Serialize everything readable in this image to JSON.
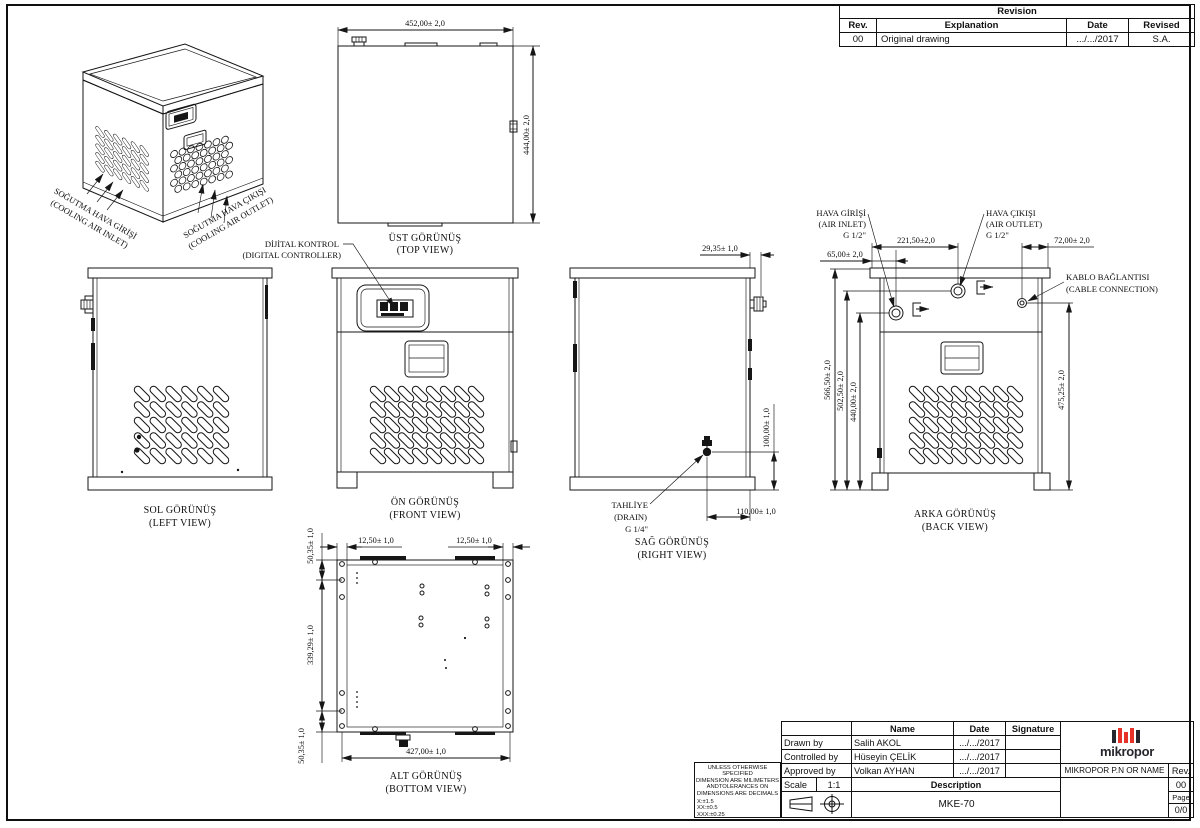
{
  "colors": {
    "line": "#161616",
    "logo_red": "#e63329",
    "logo_dark": "#26262e"
  },
  "iso_view": {
    "inlet_line1": "SOĞUTMA HAVA GİRİŞİ",
    "inlet_line2": "(COOLING AIR INLET)",
    "outlet_line1": "SOĞUTMA HAVA ÇIKIŞI",
    "outlet_line2": "(COOLING AIR OUTLET)"
  },
  "top_view": {
    "title": "ÜST GÖRÜNÜŞ",
    "subtitle": "(TOP VIEW)",
    "dim_width": "452,00± 2,0",
    "dim_depth": "444,00± 2,0"
  },
  "left_view": {
    "title": "SOL GÖRÜNÜŞ",
    "subtitle": "(LEFT VIEW)"
  },
  "front_view": {
    "title": "ÖN GÖRÜNÜŞ",
    "subtitle": "(FRONT VIEW)",
    "controller_line1": "DİJİTAL KONTROL",
    "controller_line2": "(DIGITAL CONTROLLER)"
  },
  "right_view": {
    "title": "SAĞ GÖRÜNÜŞ",
    "subtitle": "(RIGHT VIEW)",
    "dim_gland": "29,35± 1,0",
    "dim_drain_h": "100,00± 1,0",
    "dim_drain_x": "110,00± 1,0",
    "drain_line1": "TAHLİYE",
    "drain_line2": "(DRAIN)",
    "drain_line3": "G 1/4\""
  },
  "back_view": {
    "title": "ARKA GÖRÜNÜŞ",
    "subtitle": "(BACK VIEW)",
    "inlet_line1": "HAVA GİRİŞİ",
    "inlet_line2": "(AIR INLET)",
    "inlet_line3": "G 1/2\"",
    "outlet_line1": "HAVA ÇIKIŞI",
    "outlet_line2": "(AIR OUTLET)",
    "outlet_line3": "G 1/2\"",
    "cable_line1": "KABLO BAĞLANTISI",
    "cable_line2": "(CABLE CONNECTION)",
    "dim_inlet_x": "65,00± 2,0",
    "dim_outlet_x": "221,50±2,0",
    "dim_cable_x": "72,00± 2,0",
    "dim_total_h": "566,50± 2,0",
    "dim_outlet_h": "502,50± 2,0",
    "dim_inlet_h": "440,00± 2,0",
    "dim_cable_h": "475,25± 2,0"
  },
  "bottom_view": {
    "title": "ALT GÖRÜNÜŞ",
    "subtitle": "(BOTTOM VIEW)",
    "dim_rail_left": "12,50± 1,0",
    "dim_rail_right": "12,50± 1,0",
    "dim_top_offset": "50,35± 1,0",
    "dim_slot_span": "339,29± 1,0",
    "dim_bottom_offset": "50,35± 1,0",
    "dim_width": "427,00± 1,0"
  },
  "revision_table": {
    "title": "Revision",
    "col_rev": "Rev.",
    "col_explanation": "Explanation",
    "col_date": "Date",
    "col_revised": "Revised",
    "row_rev": "00",
    "row_explanation": "Original drawing",
    "row_date": ".../.../2017",
    "row_revised": "S.A."
  },
  "title_block": {
    "col_name": "Name",
    "col_date": "Date",
    "col_signature": "Signature",
    "drawn_label": "Drawn by",
    "drawn_name": "Salih AKOL",
    "drawn_date": ".../.../2017",
    "controlled_label": "Controlled by",
    "controlled_name": "Hüseyin ÇELİK",
    "controlled_date": ".../.../2017",
    "approved_label": "Approved by",
    "approved_name": "Volkan AYHAN",
    "approved_date": ".../.../2017",
    "scale_label": "Scale",
    "scale_value": "1:1",
    "description_label": "Description",
    "description_value": "MKE-70",
    "pn_label": "MIKROPOR P.N OR NAME",
    "rev_label": "Rev.",
    "rev_value": "00",
    "page_label": "Page",
    "page_value": "0/0",
    "logo_text": "mikropor"
  },
  "tolerance_note": {
    "line1": "UNLESS OTHERWISE SPECIFIED",
    "line2": "DIMENSION ARE MILIMETERS",
    "line3": "ANDTOLERANCES ON",
    "line4": "DIMENSIONS ARE  DECIMALS",
    "tol1": "X:±1.5",
    "tol2": "XX:±0.5",
    "tol3": "XXX:±0.25"
  }
}
